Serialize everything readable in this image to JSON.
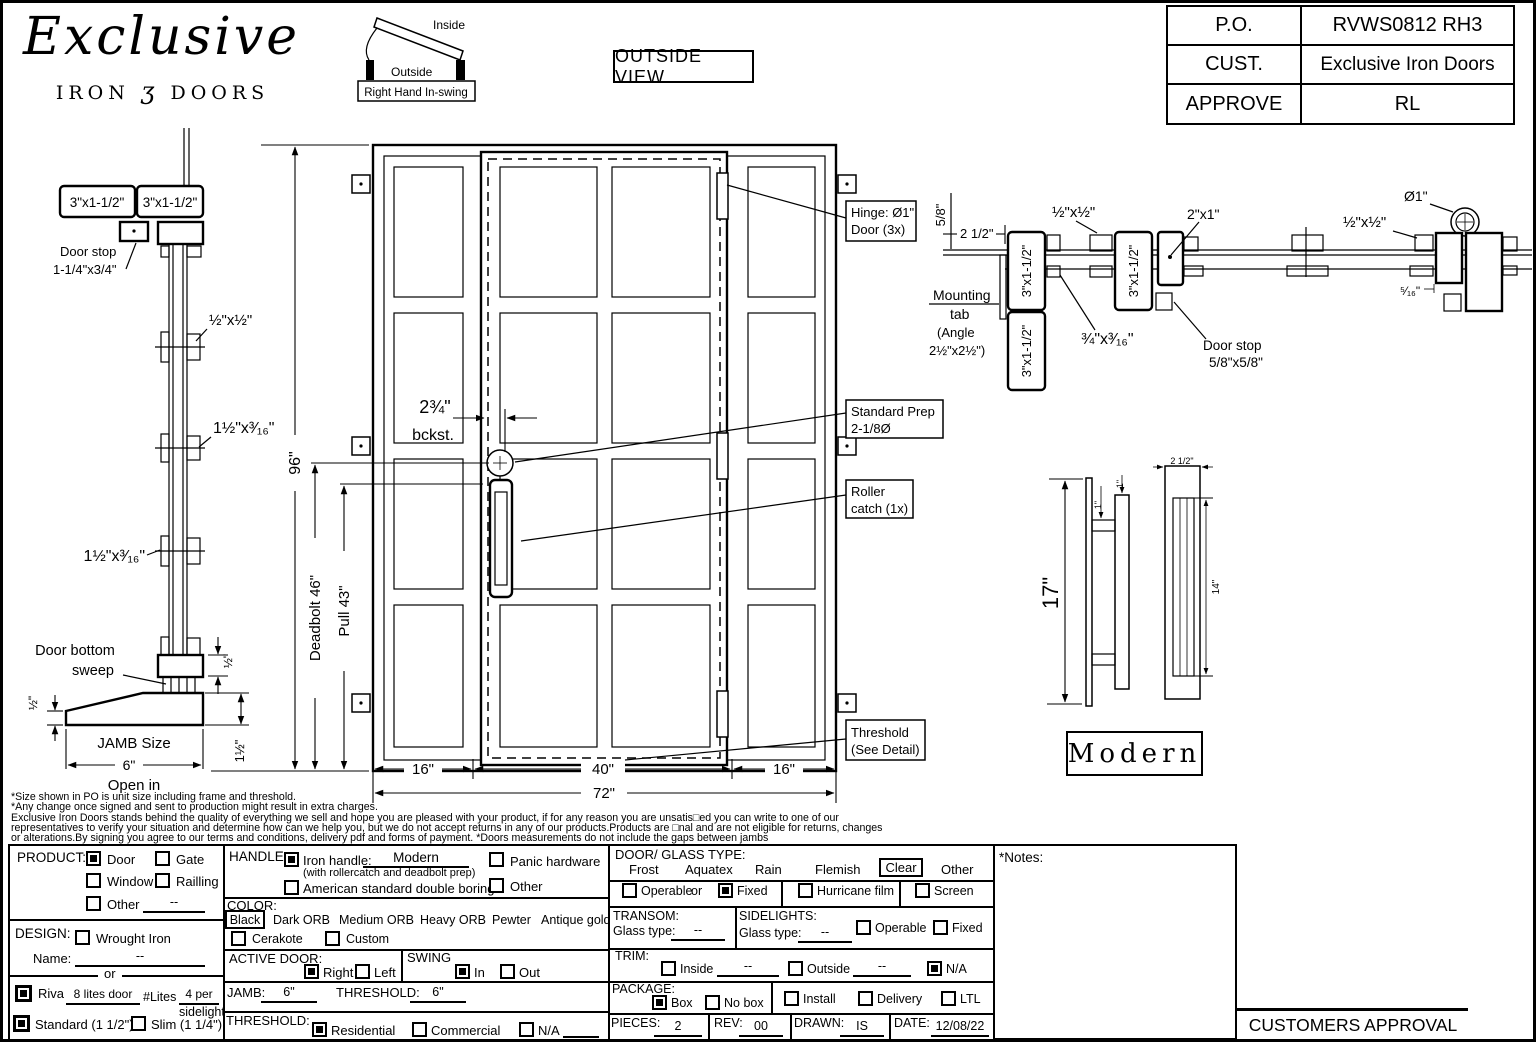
{
  "header": {
    "logo": {
      "script": "Exclusive",
      "iron": "IRON",
      "ornament": "ʒ",
      "doors": "DOORS"
    },
    "swing": {
      "inside": "Inside",
      "outside": "Outside",
      "caption": "Right Hand In-swing"
    },
    "view_label": "OUTSIDE VIEW",
    "po_table": {
      "rows": [
        {
          "k": "P.O.",
          "v": "RVWS0812 RH3"
        },
        {
          "k": "CUST.",
          "v": "Exclusive Iron Doors"
        },
        {
          "k": "APPROVE",
          "v": "RL"
        }
      ]
    }
  },
  "jamb_profile": {
    "tube_a": "3\"x1-1/2\"",
    "tube_b": "3\"x1-1/2\"",
    "door_stop_1": "Door stop",
    "door_stop_2": "1-1/4\"x3/4\"",
    "clip_a": "½\"x½\"",
    "clip_b": "1½\"x³⁄₁₆\"",
    "clip_c": "1½\"x³⁄₁₆\"",
    "sweep_1": "Door bottom",
    "sweep_2": "sweep",
    "dim_half_a": "½\"",
    "dim_half_b": "½\"",
    "dim_one_half": "1½\"",
    "jamb_size_label": "JAMB Size",
    "jamb_size_value": "6\"",
    "open_label": "Open in"
  },
  "door_view": {
    "height_dim": "96\"",
    "deadbolt_dim": "Deadbolt 46\"",
    "pull_dim": "Pull 43\"",
    "backset_1": "2¾\"",
    "backset_2": "bckst.",
    "hinge_callout_1": "Hinge: Ø1\"",
    "hinge_callout_2": "Door (3x)",
    "prep_callout_1": "Standard Prep",
    "prep_callout_2": "2-1/8Ø",
    "roller_callout_1": "Roller",
    "roller_callout_2": "catch (1x)",
    "threshold_callout_1": "Threshold",
    "threshold_callout_2": "(See Detail)",
    "width_left": "16\"",
    "width_center": "40\"",
    "width_right": "16\"",
    "width_total": "72\""
  },
  "section_view": {
    "dim_58": "5/8\"",
    "dim_2_12": "2 1/2\"",
    "clip_a": "½\"x½\"",
    "clip_b": "½\"x½\"",
    "tube_a": "3\"x1-1/2\"",
    "tube_b": "3\"x1-1/2\"",
    "tube_c": "3\"x1-1/2\"",
    "bar": "2\"x1\"",
    "flat_a": "¾\"x³⁄₁₆\"",
    "flat_b": "¾\"x³⁄₁₆\"",
    "mount_1": "Mounting",
    "mount_2": "tab",
    "mount_3": "(Angle",
    "mount_4": "2½\"x2½\")",
    "stop_1": "Door stop",
    "stop_2": "5/8\"x5/8\"",
    "hinge_dia": "Ø1\"",
    "dim_516": "⁵⁄₁₆\""
  },
  "handle_view": {
    "h17": "17\"",
    "d1_a": "1\"",
    "d1_b": "1\"",
    "w2_12": "2 1/2\"",
    "h14": "14\"",
    "style": "Modern"
  },
  "disclaimer": {
    "l1": "*Size shown in PO is unit size including frame and threshold.",
    "l2": "*Any change once signed and sent to production might result in extra charges.",
    "l3": "Exclusive Iron Doors stands behind the quality of everything we sell and hope you are pleased with your product, if for any reason you are unsatis□ed you can write to one of our",
    "l4": "representatives to verify your situation and determine how can we help you, but we do not accept returns in any of our products.Products are □nal and are not eligible for returns, changes",
    "l5": "or alterations.By signing you agree to our terms and conditions, delivery pdf and forms of payment. *Doors measurements do not include the gaps between jambs"
  },
  "form": {
    "product": {
      "label": "PRODUCT:",
      "door": "Door",
      "door_checked": true,
      "gate": "Gate",
      "gate_checked": false,
      "window": "Window",
      "window_checked": false,
      "railing": "Railling",
      "railing_checked": false,
      "other": "Other",
      "other_checked": false,
      "other_value": "--"
    },
    "design": {
      "label": "DESIGN:",
      "wrought": "Wrought Iron",
      "wrought_checked": false,
      "name_label": "Name:",
      "name_value": "--",
      "or_label": "or"
    },
    "riva": {
      "riva": "Riva",
      "riva_checked": true,
      "riva_value": "8 lites door",
      "lites_label": "#Lites",
      "lites_value": "4 per",
      "lites_value2": "sidelight",
      "standard": "Standard (1 1/2\")",
      "standard_checked": true,
      "slim": "Slim (1 1/4\")",
      "slim_checked": false
    },
    "handle": {
      "label": "HANDLE:",
      "iron": "Iron handle:",
      "iron_checked": true,
      "iron_value": "Modern",
      "iron_note": "(with rollercatch and deadbolt prep)",
      "american": "American standard double boring",
      "american_checked": false,
      "panic": "Panic hardware",
      "panic_checked": false,
      "other": "Other",
      "other_checked": false
    },
    "color": {
      "label": "COLOR:",
      "selected": "Black",
      "opt1": "Dark ORB",
      "opt2": "Medium ORB",
      "opt3": "Heavy ORB",
      "opt4": "Pewter",
      "opt5": "Antique gold",
      "cerakote": "Cerakote",
      "cerakote_checked": false,
      "custom": "Custom",
      "custom_checked": false
    },
    "active_door": {
      "label": "ACTIVE DOOR:",
      "right": "Right",
      "right_checked": true,
      "left": "Left",
      "left_checked": false
    },
    "swing": {
      "label": "SWING",
      "in": "In",
      "in_checked": true,
      "out": "Out",
      "out_checked": false
    },
    "jamb": {
      "label": "JAMB:",
      "value": "6\"",
      "threshold_label": "THRESHOLD:",
      "threshold_value": "6\""
    },
    "threshold": {
      "label": "THRESHOLD:",
      "residential": "Residential",
      "residential_checked": true,
      "commercial": "Commercial",
      "commercial_checked": false,
      "na": "N/A",
      "na_checked": false
    },
    "glass": {
      "label": "DOOR/ GLASS TYPE:",
      "frost": "Frost",
      "aquatex": "Aquatex",
      "rain": "Rain",
      "flemish": "Flemish",
      "clear": "Clear",
      "other": "Other",
      "operable": "Operable",
      "operable_checked": false,
      "or_label": "or",
      "fixed": "Fixed",
      "fixed_checked": true,
      "hurricane": "Hurricane film",
      "hurricane_checked": false,
      "screen": "Screen",
      "screen_checked": false
    },
    "transom": {
      "label": "TRANSOM:",
      "glass_label": "Glass type:",
      "value": "--"
    },
    "sidelights": {
      "label": "SIDELIGHTS:",
      "glass_label": "Glass type:",
      "value": "--",
      "operable": "Operable",
      "operable_checked": false,
      "fixed": "Fixed",
      "fixed_checked": false
    },
    "trim": {
      "label": "TRIM:",
      "inside": "Inside",
      "inside_checked": false,
      "inside_value": "--",
      "outside": "Outside",
      "outside_checked": false,
      "outside_value": "--",
      "na": "N/A",
      "na_checked": true
    },
    "package": {
      "label": "PACKAGE:",
      "box": "Box",
      "box_checked": true,
      "nobox": "No box",
      "nobox_checked": false,
      "install": "Install",
      "install_checked": false,
      "delivery": "Delivery",
      "delivery_checked": false,
      "ltl": "LTL",
      "ltl_checked": false
    },
    "meta": {
      "pieces_label": "PIECES:",
      "pieces": "2",
      "rev_label": "REV:",
      "rev": "00",
      "drawn_label": "DRAWN:",
      "drawn": "IS",
      "date_label": "DATE:",
      "date": "12/08/22"
    },
    "notes_label": "*Notes:",
    "approval": "CUSTOMERS APPROVAL"
  }
}
